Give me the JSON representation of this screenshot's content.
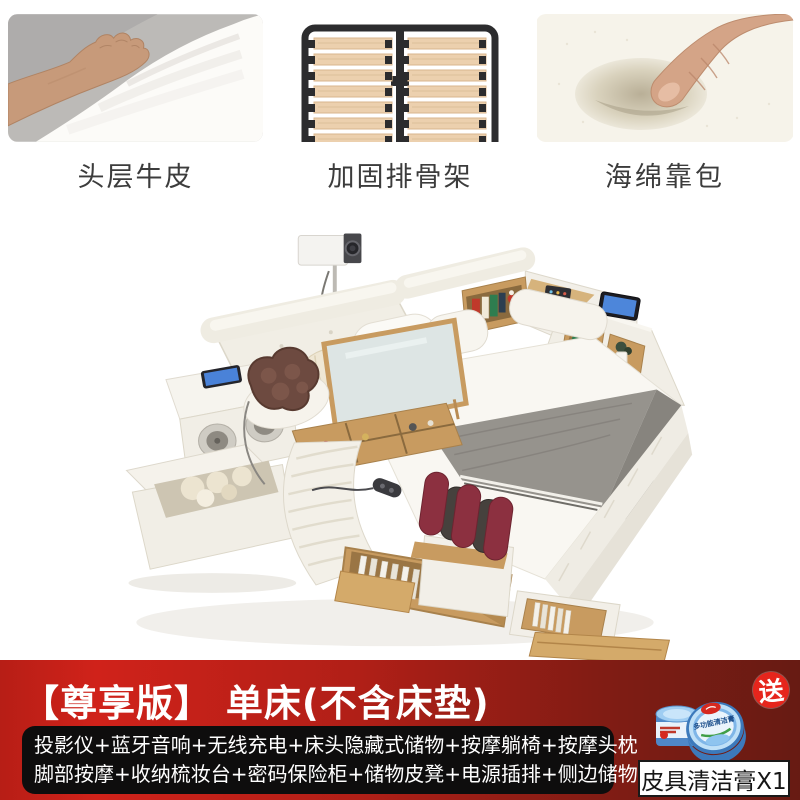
{
  "feature_cards": [
    {
      "caption": "头层牛皮",
      "image": "hand-pressing-white-leather"
    },
    {
      "caption": "加固排骨架",
      "image": "reinforced-slatted-bed-frame"
    },
    {
      "caption": "海绵靠包",
      "image": "thumb-pressing-sponge-foam"
    }
  ],
  "banner": {
    "title": "【尊享版】 单床(不含床垫)",
    "features_line1": "投影仪+蓝牙音响+无线充电+床头隐藏式储物+按摩躺椅+按摩头枕",
    "features_line2": "脚部按摩+收纳梳妆台+密码保险柜+储物皮凳+电源插排+侧边储物柜",
    "gift": {
      "seal": "送",
      "tin_label": "多功能清洁膏",
      "caption": "皮具清洁膏X1"
    }
  },
  "theme": {
    "page_bg": "#ffffff",
    "caption_color": "#3c3c3c",
    "banner_red_left": "#b71e16",
    "banner_red_bright": "#d0221a",
    "banner_red_mid": "#b01f17",
    "banner_red_deep": "#811c14",
    "banner_red_dark": "#671b13",
    "seal_red": "#e6251c",
    "feature_box_bg": "#0e0d0d"
  }
}
